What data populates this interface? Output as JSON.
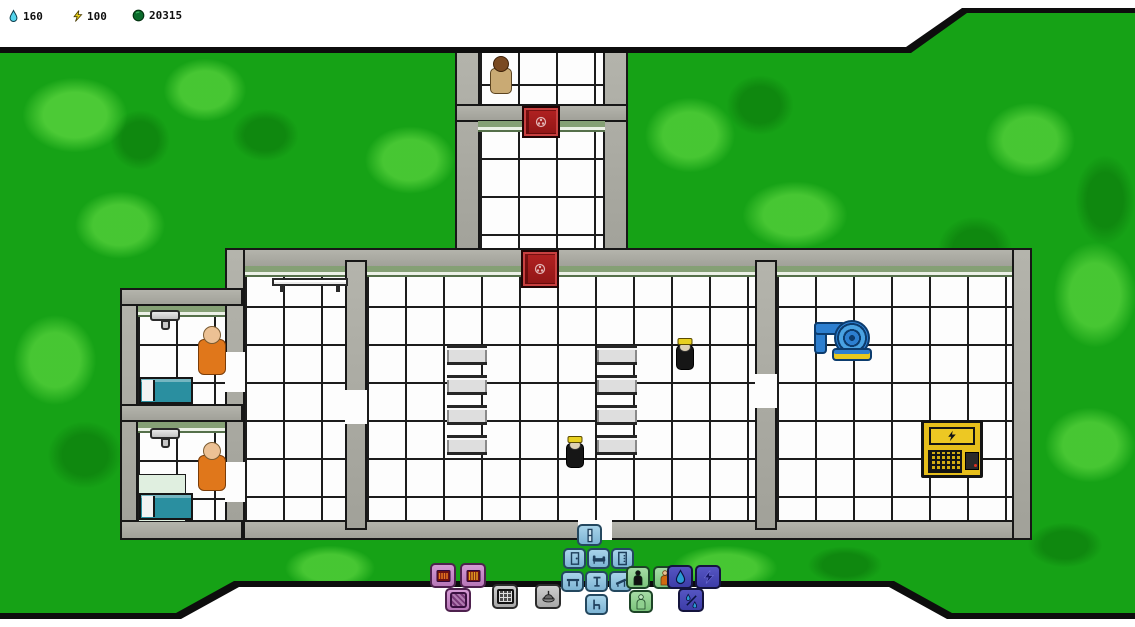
{
  "hud": {
    "resources": [
      {
        "id": "water",
        "icon": "water-drop-icon",
        "value": "160",
        "color": "#54d4ec"
      },
      {
        "id": "power",
        "icon": "lightning-icon",
        "value": "100",
        "color": "#ecd41c"
      },
      {
        "id": "funds",
        "icon": "coin-icon",
        "value": "20315",
        "color": "#0b6b2b"
      }
    ]
  },
  "toolbar": {
    "groups": [
      {
        "id": "decor",
        "color": "#b877b8",
        "buttons": [
          "heater-a",
          "heater-b",
          "floor-pattern"
        ]
      },
      {
        "id": "machines",
        "color": "#b0b0b0",
        "buttons": [
          "console",
          "ceiling-lamp"
        ]
      },
      {
        "id": "furniture",
        "color": "#7db4d4",
        "buttons": [
          "window",
          "door",
          "bed",
          "locker",
          "table",
          "stand",
          "lounger",
          "chair"
        ]
      },
      {
        "id": "people",
        "color": "#7cc47c",
        "buttons": [
          "guard",
          "worker",
          "civilian"
        ]
      },
      {
        "id": "utilities",
        "color": "#3d3da8",
        "buttons": [
          "water",
          "power",
          "drain"
        ]
      }
    ]
  },
  "world": {
    "characters": [
      {
        "type": "visitor",
        "location": "north-corridor",
        "color": "#c9aa74"
      },
      {
        "type": "patient",
        "location": "cell-a",
        "color": "#e0771b"
      },
      {
        "type": "patient",
        "location": "cell-b",
        "color": "#e0771b"
      },
      {
        "type": "guard",
        "location": "main-hall",
        "color": "#1a1a1a"
      },
      {
        "type": "guard",
        "location": "main-hall",
        "color": "#1a1a1a"
      }
    ],
    "objects": [
      {
        "type": "secure-door",
        "count": 2,
        "color": "#a81c1c"
      },
      {
        "type": "sink",
        "count": 2
      },
      {
        "type": "bed",
        "count": 2,
        "color": "#2a8fa0"
      },
      {
        "type": "wall-bench",
        "count": 1
      },
      {
        "type": "table-row",
        "count": 8
      },
      {
        "type": "water-pump",
        "count": 1,
        "color": "#2d7fd0"
      },
      {
        "type": "generator",
        "count": 1,
        "color": "#e6be1b"
      }
    ]
  },
  "colors": {
    "terrain": "#16a216",
    "wall": "#a8a8a0",
    "floor": "#fdfdfd",
    "trim": "#85a075",
    "secure_door": "#a81c1c"
  }
}
